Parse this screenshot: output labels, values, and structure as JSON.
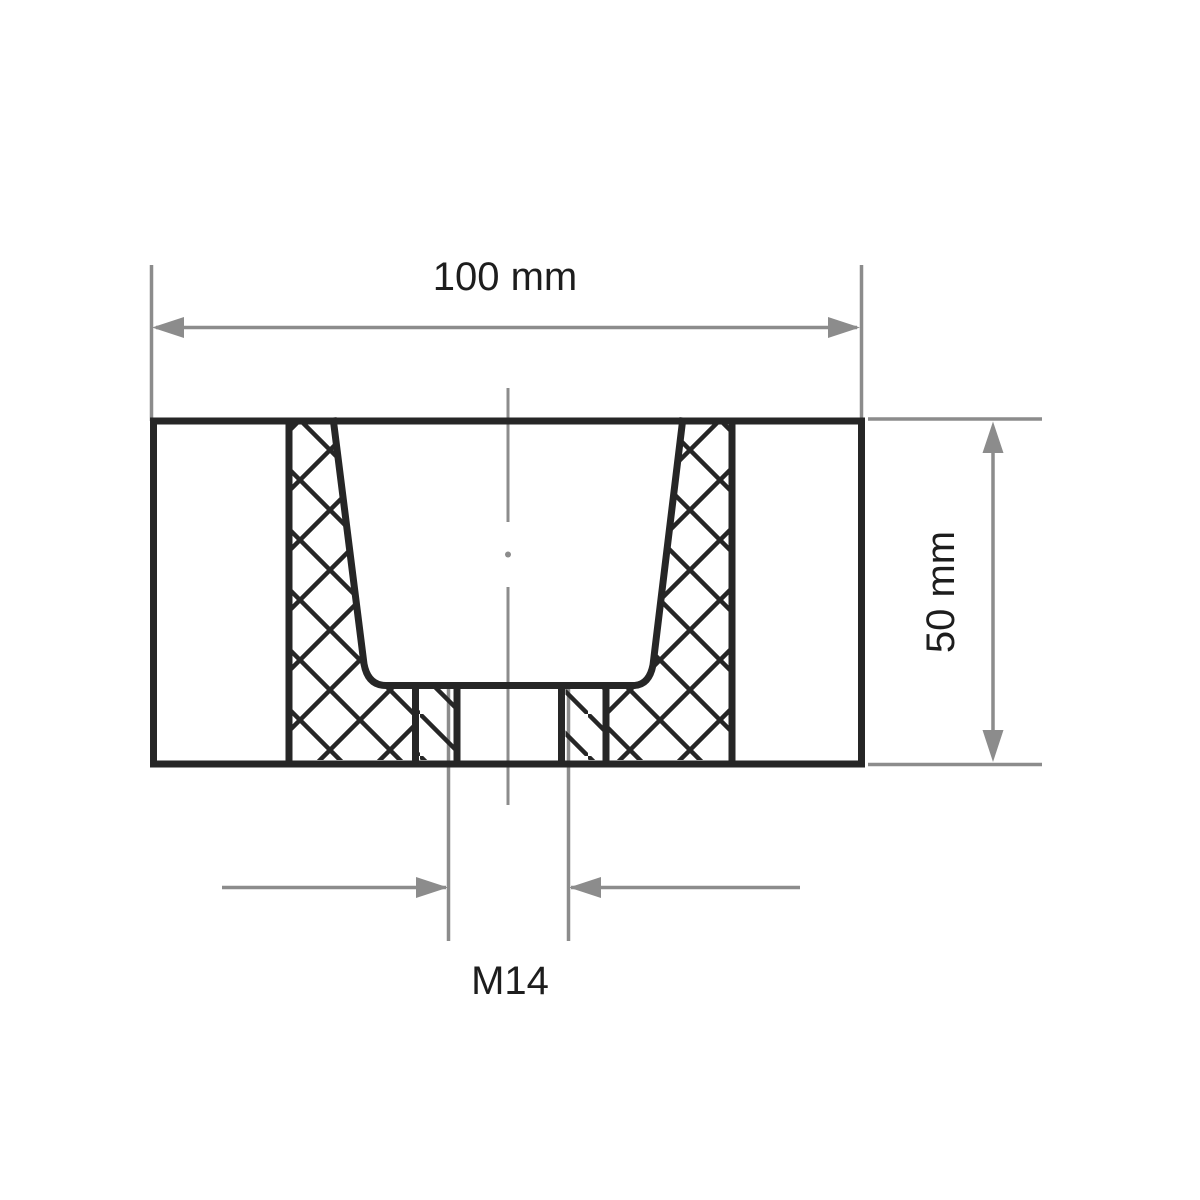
{
  "labels": {
    "width": "100 mm",
    "height": "50 mm",
    "thread": "M14"
  },
  "colors": {
    "outline": "#262626",
    "dimension": "#8c8c8c",
    "text": "#1d1d1d",
    "background": "#ffffff"
  }
}
